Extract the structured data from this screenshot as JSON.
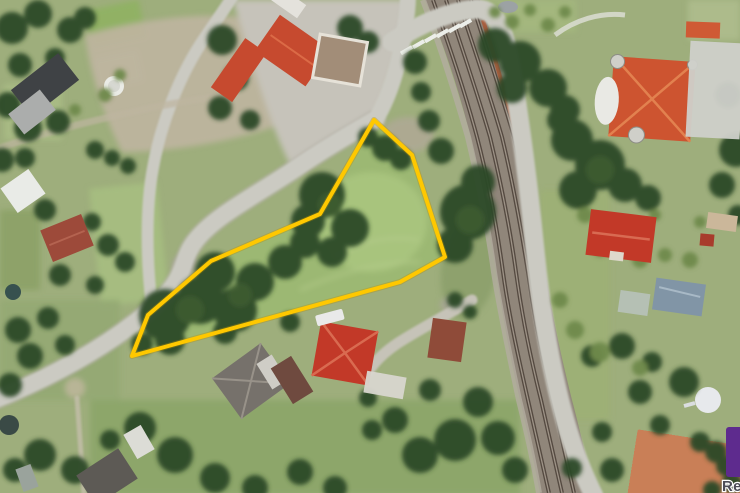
{
  "image": {
    "kind": "aerial-satellite-photo",
    "width": 740,
    "height": 493
  },
  "parcel": {
    "outline_color": "#FFC800",
    "outline_shadow_color": "#B88E00",
    "outline_width": 4,
    "points": "374,120 412,155 445,257 400,282 132,356 148,315 211,261 320,214",
    "fill_color": "#9CB873"
  },
  "watermark": {
    "logo_color": "#5E2B8E",
    "text": "Re",
    "text_color": "#4D4D57"
  },
  "palette": {
    "ground_grass": "#9EAE7C",
    "tree_dark": "#2C4926",
    "bush_light": "#6F8A4C",
    "road": "#CBCAC2",
    "railway_ballast": "#90867A",
    "rail_dark": "#4F443B",
    "roof_red": "#C23928",
    "roof_orange_villa": "#CD5430",
    "roof_orange_top": "#C64A2F",
    "roof_gray": "#76716B",
    "tennis_clay": "#C97F57",
    "wall_orange": "#A85A38"
  }
}
